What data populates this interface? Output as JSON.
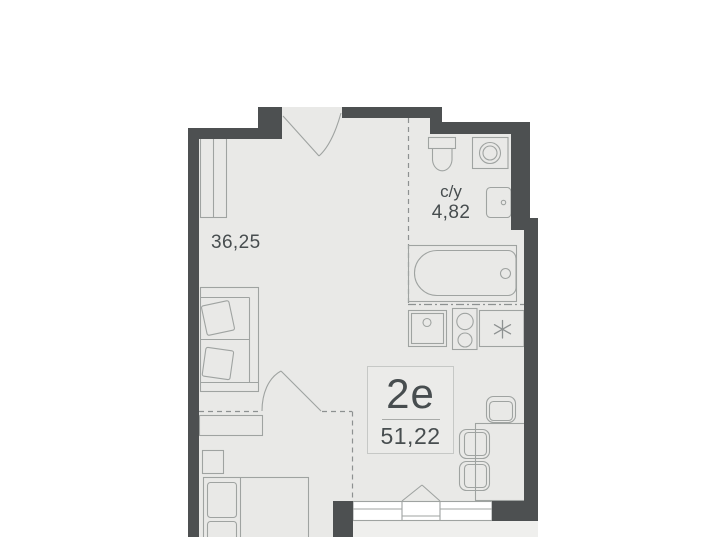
{
  "plan": {
    "unit_card": {
      "type_label": "2е",
      "total_area": "51,22"
    },
    "labels": {
      "living_area": "36,25",
      "bathroom_name": "с/у",
      "bathroom_area": "4,82"
    },
    "fixtures": {
      "bathroom": [
        "toilet",
        "washing-machine",
        "bathroom-sink",
        "bathtub"
      ],
      "kitchen": [
        "kitchen-sink",
        "stove",
        "refrigerator"
      ],
      "living": [
        "wardrobe",
        "sofa",
        "radiator",
        "dining-table",
        "chair",
        "chair",
        "chair"
      ],
      "bedroom": [
        "bed",
        "nightstand"
      ],
      "openings": [
        "entrance-door",
        "interior-door",
        "balcony-door",
        "window",
        "balcony"
      ]
    }
  },
  "colors": {
    "background": "#ffffff",
    "floor": "#e9e9e7",
    "balcony_floor": "#efefed",
    "wall": "#4d5051",
    "outline": "#9fa3a1",
    "hatch": "#aaadab",
    "dash": "#8d9191",
    "text": "#474d4f",
    "card_bg": "#ebebe9",
    "card_border": "#c6c8c6",
    "divider": "#a9aba9",
    "window_fill": "#ffffff"
  }
}
